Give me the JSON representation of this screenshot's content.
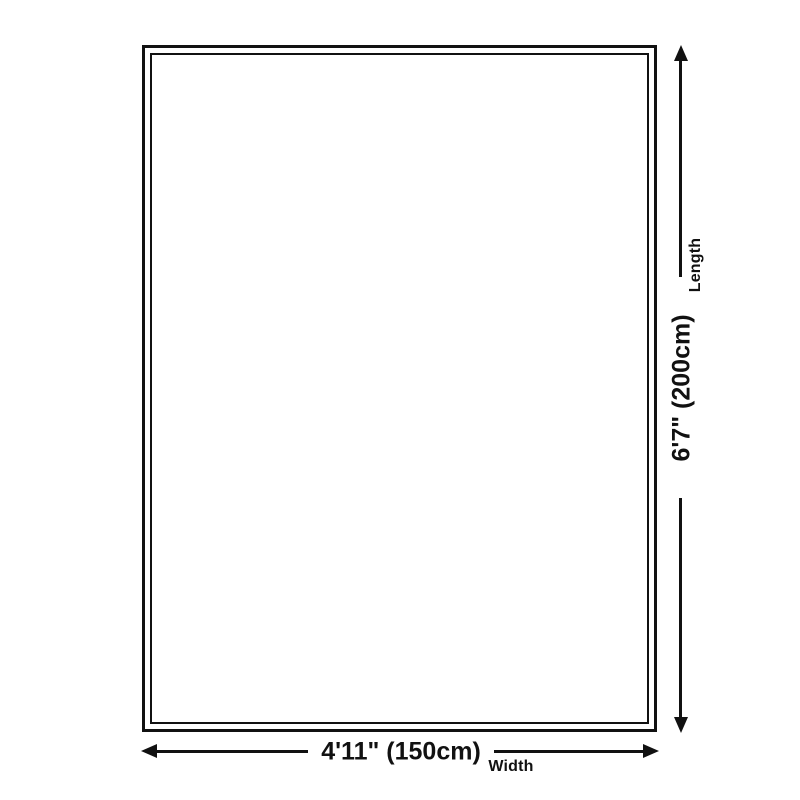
{
  "diagram": {
    "type": "product-dimension-diagram",
    "dimensions": {
      "length": {
        "value": "6'7\" (200cm)",
        "label": "Length"
      },
      "width": {
        "value": "4'11\" (150cm)",
        "label": "Width"
      }
    },
    "colors": {
      "line": "#111111",
      "background": "#ffffff"
    }
  }
}
